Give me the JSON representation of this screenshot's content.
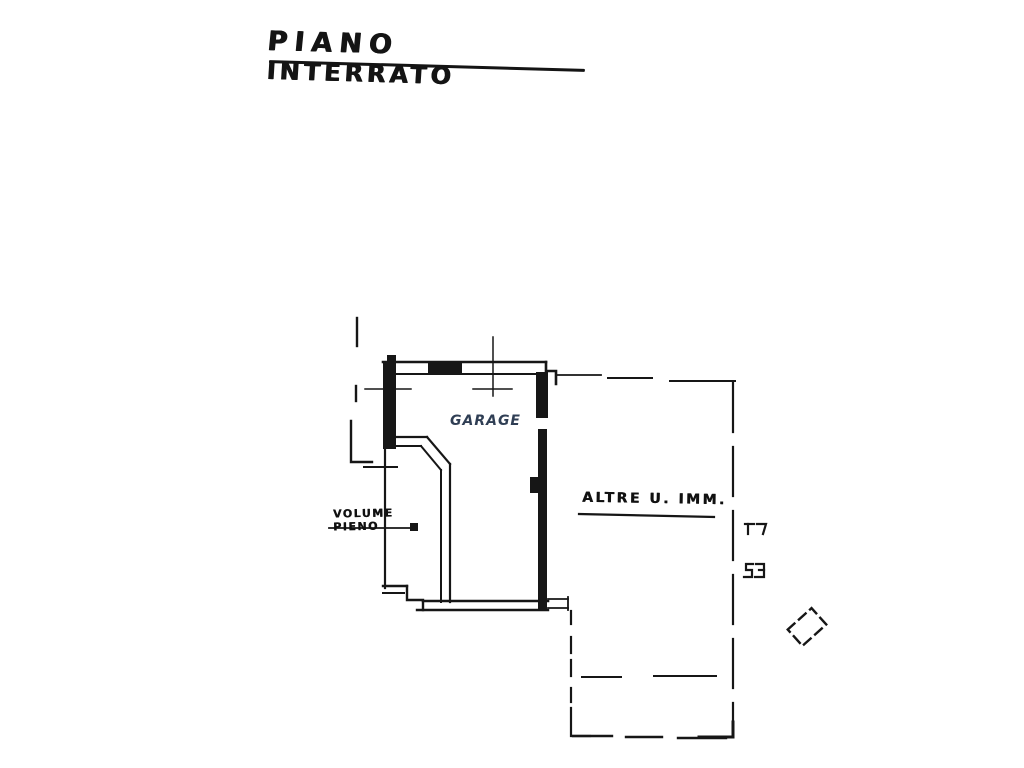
{
  "title": {
    "word1": "PIANO",
    "word2": "INTERRATO"
  },
  "labels": {
    "room": "GARAGE",
    "volume_line1": "VOLUME",
    "volume_line2": "PIENO",
    "other_units": "ALTRE  U. IMM."
  },
  "colors": {
    "ink": "#161616",
    "room_label": "#2f3e54",
    "background": "#ffffff"
  },
  "icons": {
    "survey_cross": "cross-mark",
    "door_code_upper": "bracket-mark",
    "door_code_lower": "bracket-mark",
    "pillar": "rotated-dashed-rectangle"
  }
}
